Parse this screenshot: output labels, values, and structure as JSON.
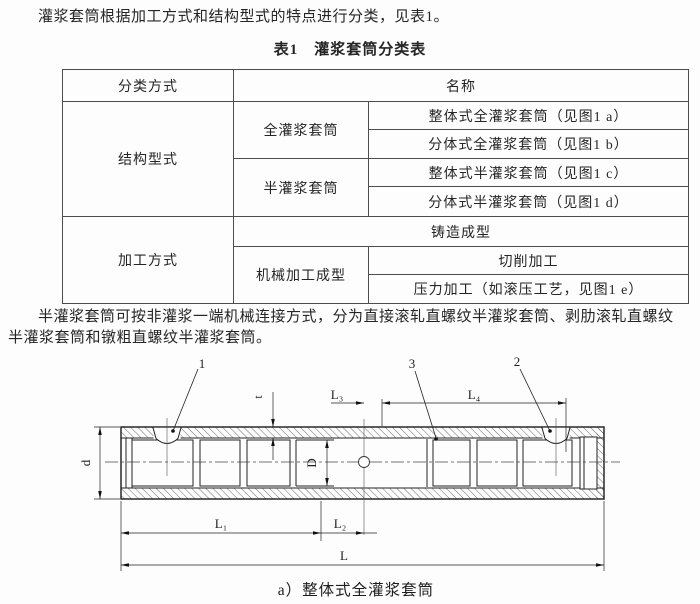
{
  "page": {
    "paragraph1": "灌浆套筒根据加工方式和结构型式的特点进行分类，见表1。",
    "table_title": "表1　灌浆套筒分类表",
    "paragraph2_line1": "半灌浆套筒可按非灌浆一端机械连接方式，分为直接滚轧直螺纹半灌浆套筒、剥肋滚轧直螺纹",
    "paragraph2_line2": "半灌浆套筒和镦粗直螺纹半灌浆套筒。"
  },
  "table": {
    "header": {
      "col1": "分类方式",
      "col2": "名称"
    },
    "rows": {
      "structure_label": "结构型式",
      "full_sleeve": "全灌浆套筒",
      "full_a": "整体式全灌浆套筒（见图1 a）",
      "full_b": "分体式全灌浆套筒（见图1 b）",
      "half_sleeve": "半灌浆套筒",
      "half_c": "整体式半灌浆套筒（见图1 c）",
      "half_d": "分体式半灌浆套筒（见图1 d）",
      "process_label": "加工方式",
      "casting": "铸造成型",
      "machining": "机械加工成型",
      "cutting": "切削加工",
      "pressing": "压力加工（如滚压工艺，见图1 e）"
    }
  },
  "diagram": {
    "callout_1": "1",
    "callout_2": "2",
    "callout_3": "3",
    "dim_d": "d",
    "dim_t": "t",
    "dim_D": "D",
    "dim_L1": "L₁",
    "dim_L2": "L₂",
    "dim_L3": "L₃",
    "dim_L4": "L₄",
    "dim_L": "L",
    "caption": "a）整体式全灌浆套筒"
  },
  "colors": {
    "text": "#252525",
    "table_border": "#4d4d4d",
    "line": "#222222",
    "background": "#fdfdfd"
  }
}
